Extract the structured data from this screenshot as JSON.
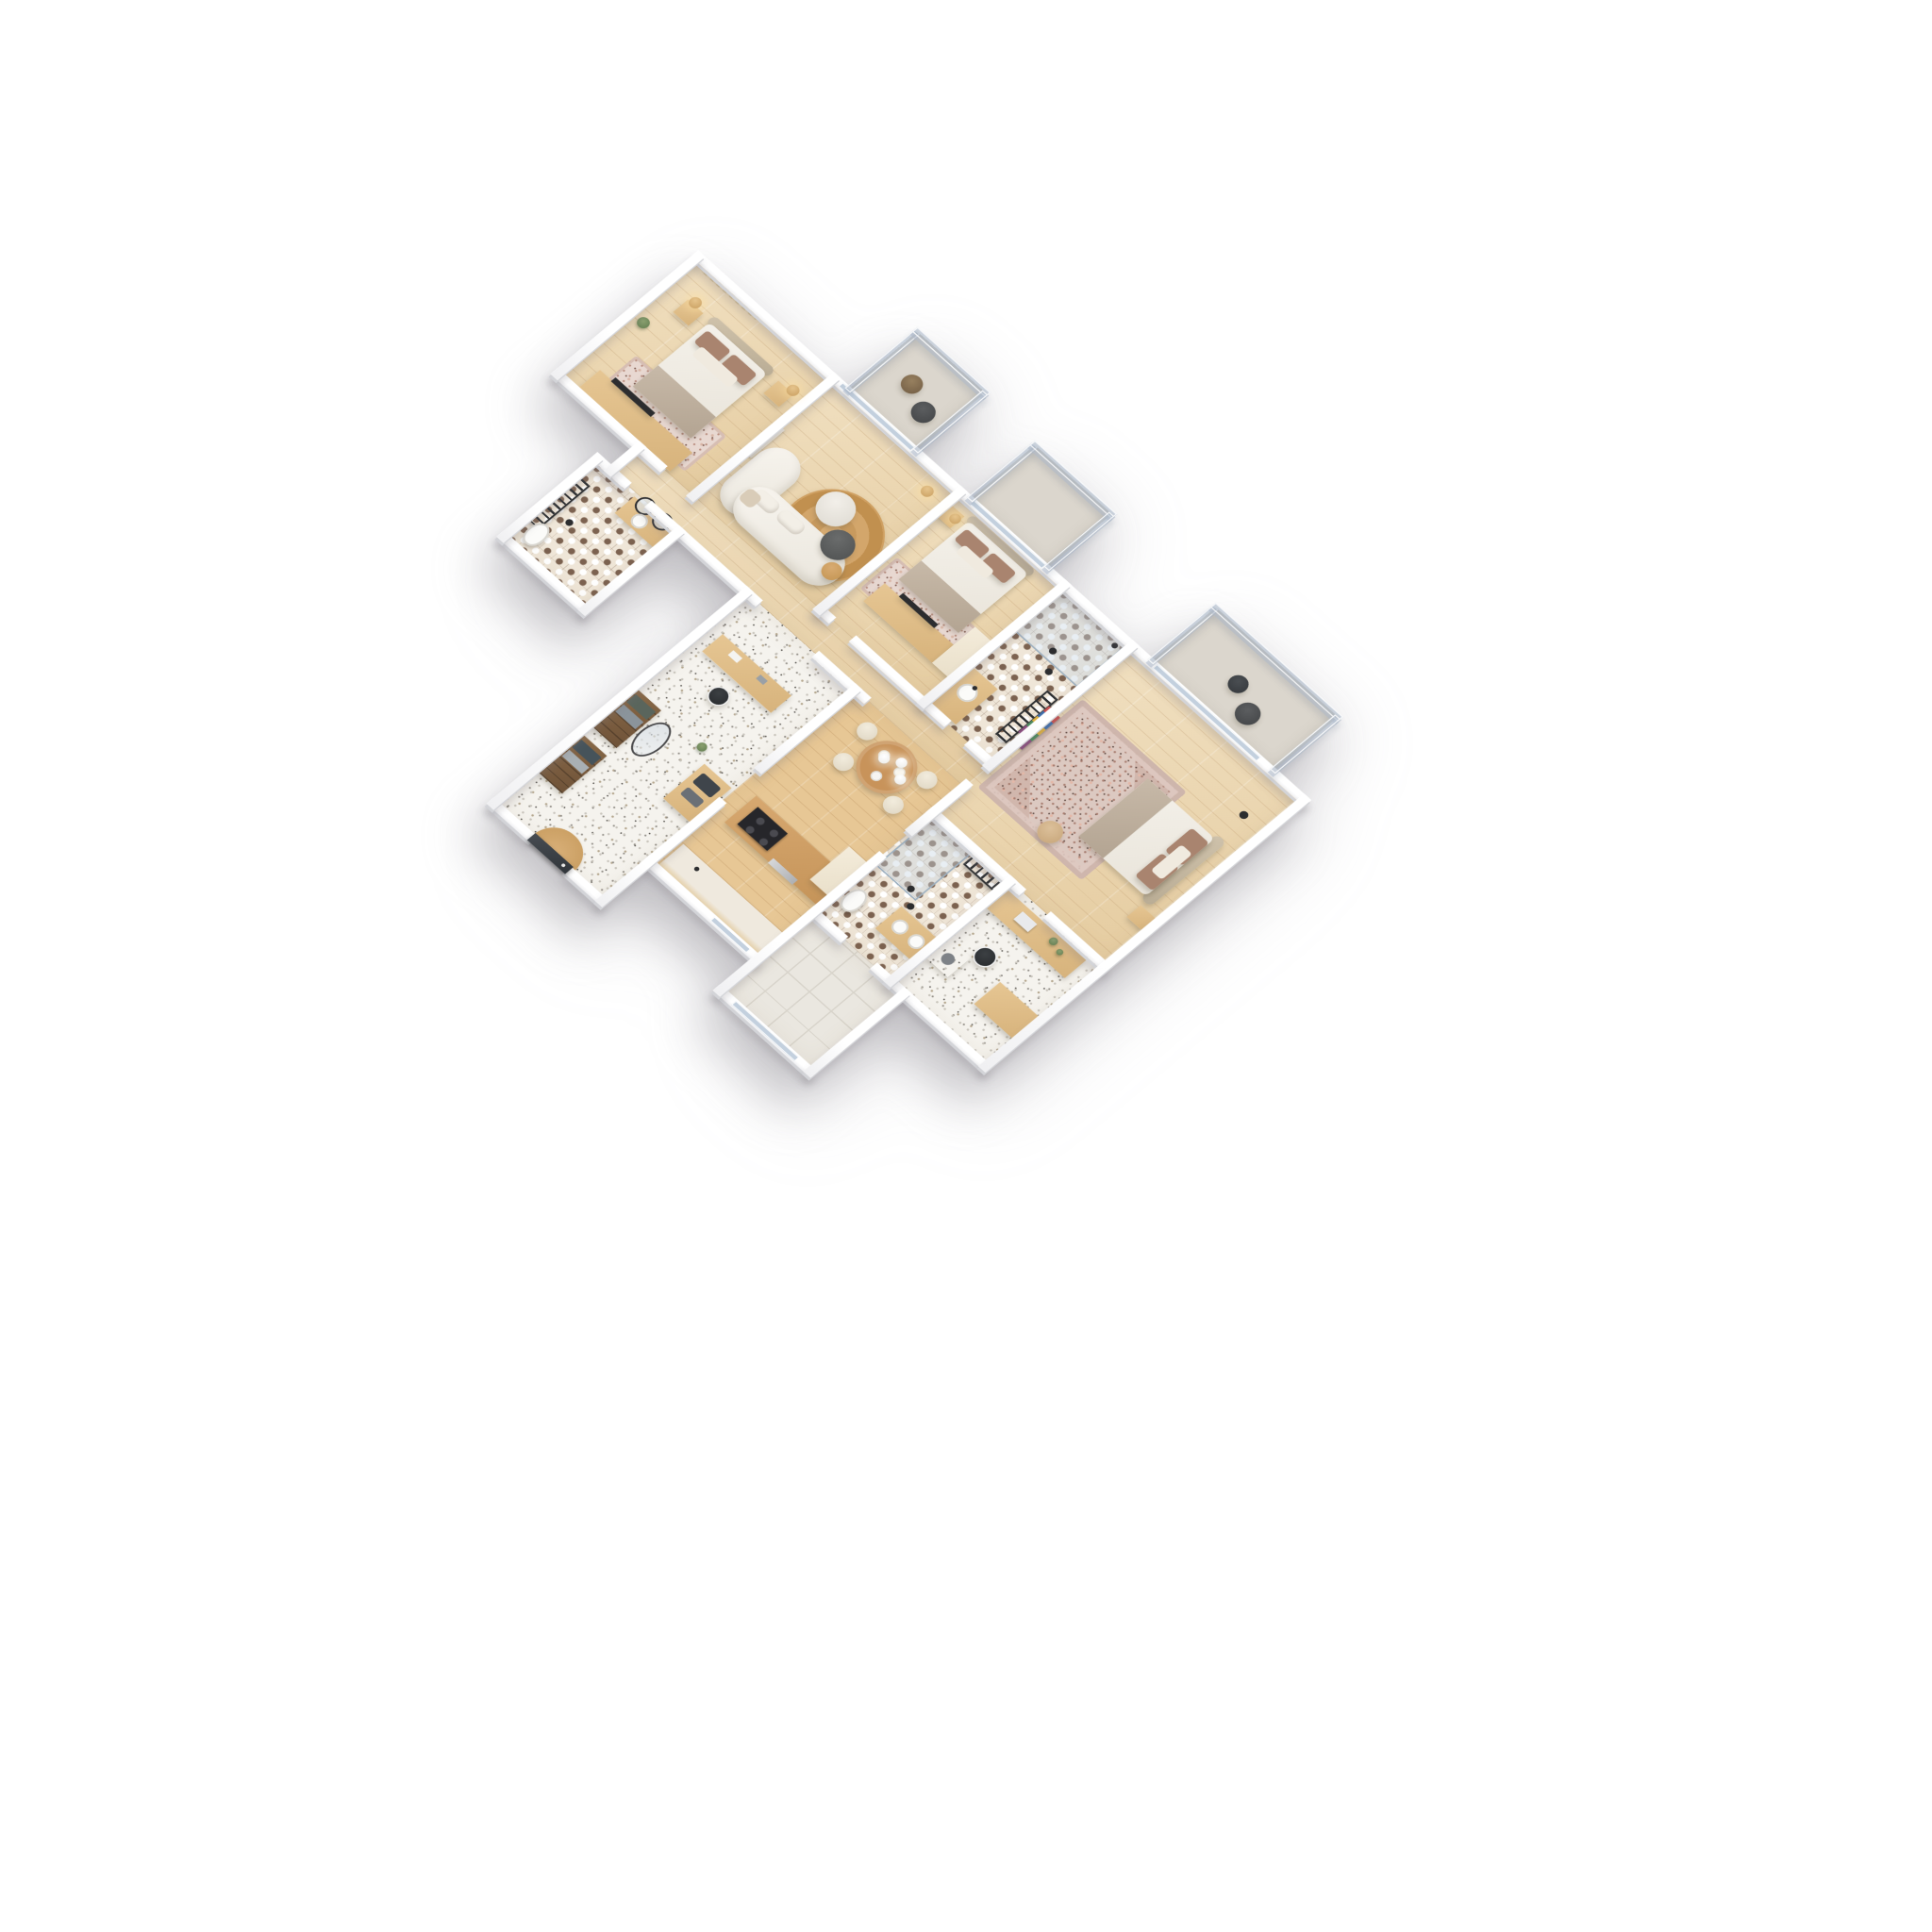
{
  "scene": {
    "title": "Isometric 3D apartment floor plan render",
    "type": "architectural 3d floor plan",
    "background": "#ffffff",
    "projection": "isometric bird's-eye",
    "text_visible": false
  },
  "palette": {
    "bg": "#ffffff",
    "wall": "#fafafa",
    "wallshade": "#d3d4d8",
    "woodfloor": "#ebd4a9",
    "kitchenfloor": "#e7c795",
    "tilebase": "#efe6d8",
    "tiledot": "#7c6250",
    "terrazzo": "#f5f3ee",
    "balcony": "#dbd6cd",
    "loggia": "#eae7e0",
    "glass": "#bccadb",
    "woodfurniture": "#dcb981",
    "darkaccent": "#2c2d2f",
    "jute": "#cfa062",
    "duvet": "#f2efe8",
    "pillow": "#a9846f",
    "gold": "#d2a873",
    "doordark": "#3b4046"
  },
  "rooms": {
    "bedroom1": {
      "name": "Bedroom 1",
      "floor": "oak parquet",
      "furniture": [
        "double bed",
        "curved headboard",
        "brown pillows",
        "beige throw",
        "two nightstands",
        "two rattan pendant lamps",
        "wardrobe with TV",
        "patterned rug",
        "curtain"
      ]
    },
    "living": {
      "name": "Living room",
      "floor": "oak parquet",
      "furniture": [
        "white curved sofa with chaise",
        "marble coffee table",
        "dark round table",
        "small tan table",
        "round jute rug",
        "rattan floor lamp",
        "plaster wall art"
      ]
    },
    "balcony1": {
      "name": "Balcony 1",
      "floor": "concrete",
      "furniture": [
        "lounge chair",
        "round side table",
        "glass balustrade"
      ]
    },
    "balcony2": {
      "name": "Balcony 2",
      "floor": "concrete",
      "furniture": [
        "glass balustrade"
      ]
    },
    "balcony3": {
      "name": "Balcony 3",
      "floor": "concrete",
      "furniture": [
        "lounge chair",
        "round side table",
        "glass balustrade"
      ]
    },
    "bedroom2": {
      "name": "Bedroom 2",
      "floor": "oak parquet",
      "furniture": [
        "double bed",
        "headboard",
        "nightstand",
        "rattan pendant",
        "wardrobe with TV",
        "white cabinet",
        "rug"
      ]
    },
    "bathroom2": {
      "name": "Bathroom 2",
      "floor": "patterned cement tile",
      "furniture": [
        "walk-in shower",
        "wood vanity with sink",
        "black towel radiator",
        "black pendants",
        "artwork"
      ]
    },
    "bedroom3": {
      "name": "Bedroom 3",
      "floor": "oak parquet",
      "furniture": [
        "double bed",
        "headboard",
        "ornate area rug",
        "pouf",
        "nightstand",
        "black floor lamp",
        "artwork"
      ]
    },
    "bathroom3": {
      "name": "Bathroom 3",
      "floor": "patterned cement tile",
      "furniture": [
        "walk-in shower",
        "double-sink vanity",
        "towel radiator",
        "toilet",
        "black pendants"
      ]
    },
    "bathroom1": {
      "name": "Bathroom 1",
      "floor": "patterned cement tile",
      "furniture": [
        "vanity with round mirrors",
        "sink",
        "towel radiator",
        "toilet",
        "black pendant"
      ]
    },
    "entry": {
      "name": "Entry hall & study",
      "floor": "terrazzo",
      "furniture": [
        "desk with chair",
        "open wardrobe shelving",
        "folded clothes",
        "oval mirror",
        "console",
        "plants",
        "half-round doormat",
        "dark front door"
      ]
    },
    "corridor": {
      "name": "Corridor",
      "floor": "oak parquet",
      "furniture": []
    },
    "kitchen": {
      "name": "Kitchen & dining",
      "floor": "oak parquet",
      "furniture": [
        "island with cooktop and oven",
        "counter unit",
        "tall cream cabinet",
        "round dining table with plates",
        "four cream chairs",
        "three white globe pendants"
      ]
    },
    "utility": {
      "name": "Utility / home office",
      "floor": "terrazzo",
      "furniture": [
        "two wood desks",
        "laptop",
        "plants",
        "black chair",
        "washing machine"
      ]
    },
    "loggia": {
      "name": "Loggia",
      "floor": "ceramic tile",
      "furniture": []
    }
  }
}
